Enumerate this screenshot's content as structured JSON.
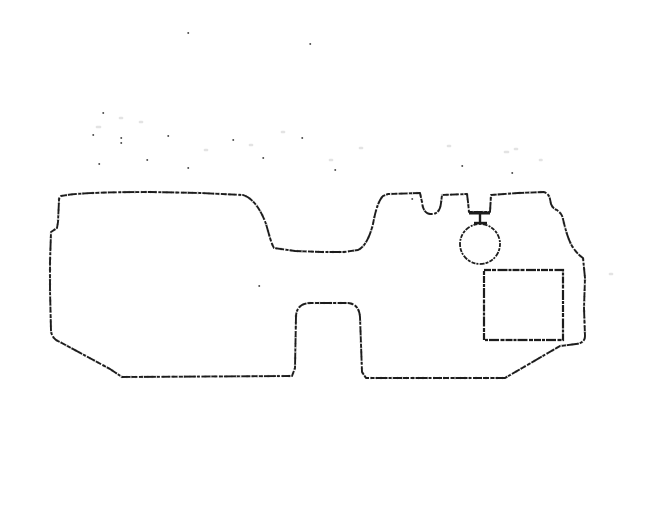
{
  "canvas": {
    "viewbox": "0 0 656 524",
    "width": 656,
    "height": 524
  },
  "colors": {
    "bg": "#ffffff",
    "ink": "#1c1c1c",
    "faint": "#9a9a9a"
  },
  "drawing": {
    "outline": {
      "d": "M 61,196 C 75,193 110,192 150,192 L 200,193 L 243,195 C 253,198 261,210 266,224 C 269,234 271,243 274,248 L 295,251 L 322,252 L 344,252 L 358,250 C 365,247 370,236 373,224 C 375,213 378,201 383,196 L 388,194 L 420,193 L 422,202 Q 423,213 430,214 L 433,214 Q 440,213 441,203 L 442,195 L 467,194 L 468,202 L 469,212 L 490,212 L 491,195 L 518,193 L 544,192 Q 549,194 550,199 L 551,204 Q 553,209 557,210 L 559,212 Q 562,214 563,219 C 565,228 568,239 572,246 Q 577,254 583,258 L 585,278 L 584,308 L 585,336 Q 585,343 576,344 L 560,346 L 505,378 L 366,378 L 362,372 L 360,317 Q 359,304 348,303 L 311,303 Q 297,303 296,316 L 295,368 L 292,376 L 122,377 L 110,369 L 60,342 Q 52,339 51,331 L 50,290 L 50,262 L 51,232 L 57,228 L 58,222 L 59,200 Q 59,197 61,196 Z"
    },
    "grommet_circle": {
      "d": "M 460,244 a 20,20 0 1 0 40,0 a 20,20 0 1 0 -40,0 Z"
    },
    "access_rect": {
      "d": "M 484,270 L 563,270 L 563,340 L 484,340 Z"
    },
    "connector_stem": {
      "d": "M 480,214 L 480,222"
    },
    "connector_bar": {
      "d": "M 474,223 L 487,223"
    },
    "notch_bar": {
      "d": "M 469,213 L 490,213"
    },
    "speckles_dark": {
      "d": "M188,33h.5 M310,44h.5 M103,113h.5 M93,135h.5 M121,138h.5 M121,143h.5 M99,164h.5 M168,136h.5 M233,140h.5 M302,138h.5 M263,158h.5 M188,168h.5 M147,160h.5 M335,170h.5 M412,199h.5 M512,173h.5 M462,166h.5 M259,286h.5"
    },
    "speckles_faint": {
      "d": "M140,122h2 M97,127h3 M205,150h2 M282,132h2 M330,160h2 M360,148h2 M505,152h3 M515,149h2 M448,146h2 M610,274h2 M540,160h1.5 M120,118h2 M250,145h2"
    }
  }
}
